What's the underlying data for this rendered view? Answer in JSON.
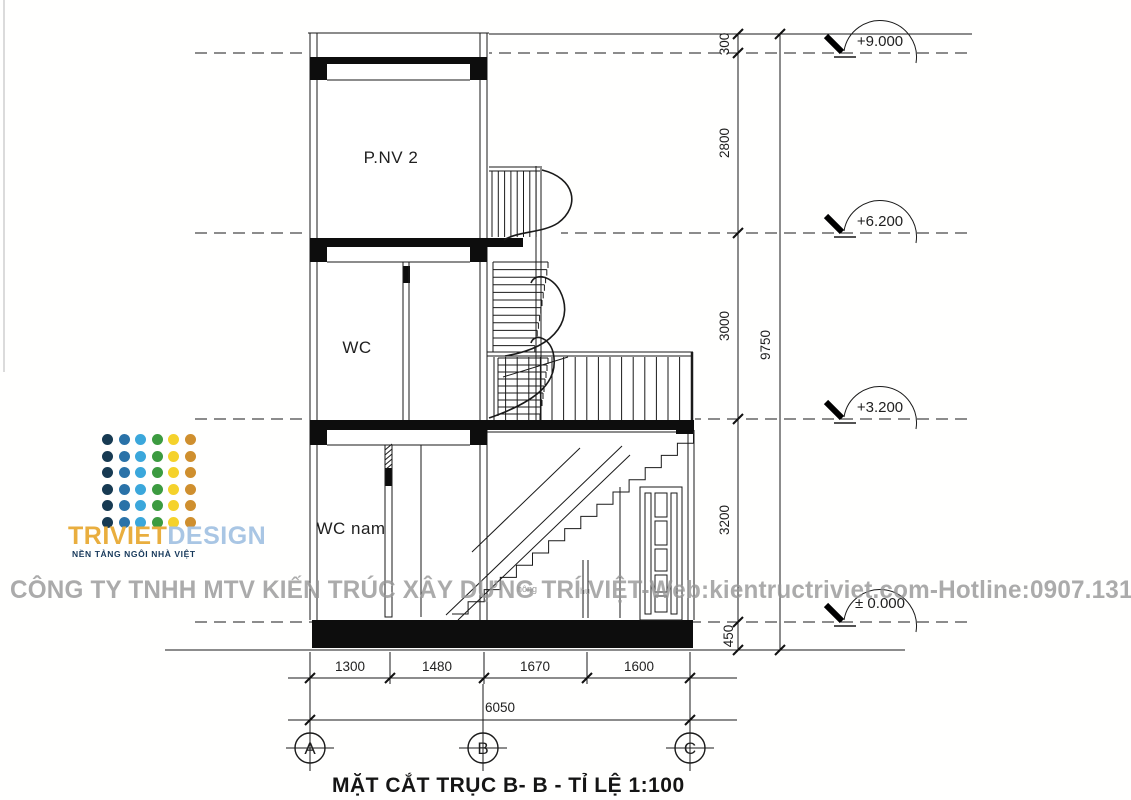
{
  "title_block": {
    "caption": "MẶT CẮT TRỤC  B- B   -   TỈ LỆ 1:100"
  },
  "watermark": {
    "text": "CÔNG TY TNHH MTV KIẾN TRÚC XÂY DỰNG TRÍ VIỆT-Web:kientructriviet.com-Hotline:0907.131.676",
    "color": "#969696"
  },
  "logo": {
    "name_part1": "TRIVIET",
    "name_part2": "DESIGN",
    "tagline": "NỀN TẢNG NGÔI NHÀ VIỆT",
    "name_part1_color": "#e9ae3e",
    "name_part2_color": "#a9c6e4",
    "tagline_color": "#17395b",
    "dot_colors": [
      "#173a52",
      "#2a72a8",
      "#3ba7db",
      "#3c9b40",
      "#f5d22b",
      "#cf8f2e"
    ]
  },
  "rooms": {
    "top": "P.NV 2",
    "middle": "WC",
    "ground": "WC nam"
  },
  "levels": {
    "roof": "+9.000",
    "floor2": "+6.200",
    "floor1": "+3.200",
    "ground": "± 0.000"
  },
  "dims": {
    "vertical": [
      "300",
      "2800",
      "3000",
      "3200",
      "450"
    ],
    "vertical_total": "9750",
    "horizontal": [
      "1300",
      "1480",
      "1670",
      "1600"
    ],
    "horizontal_total": "6050"
  },
  "grid_labels": [
    "A",
    "B",
    "C"
  ],
  "annotations": {
    "a1": "hông",
    "a2": "hu"
  },
  "colors": {
    "ink": "#1a1a1a",
    "slab": "#0d0d0d"
  }
}
